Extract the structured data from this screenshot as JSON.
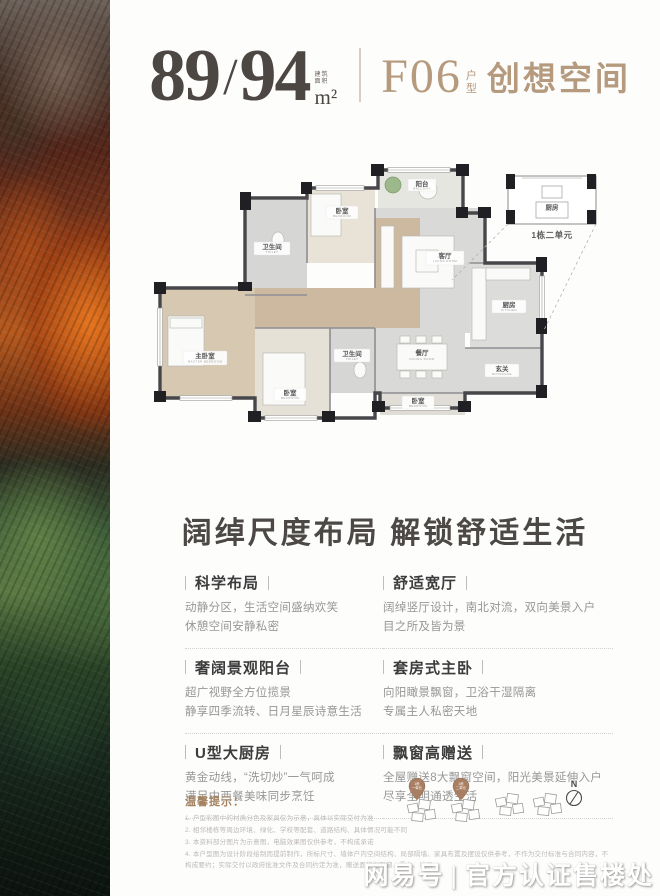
{
  "header": {
    "area_main": "89",
    "area_slash": "/",
    "area_alt": "94",
    "area_note_1": "建筑",
    "area_note_2": "面积",
    "area_unit": "m²",
    "type_code": "F06",
    "type_label_1": "户",
    "type_label_2": "型",
    "type_name": "创想空间"
  },
  "floorplan": {
    "rooms": [
      {
        "name": "阳台",
        "en": "BALCONY"
      },
      {
        "name": "卧室",
        "en": "BEDROOM"
      },
      {
        "name": "卫生间",
        "en": "TOILET"
      },
      {
        "name": "客厅",
        "en": "LIVING ROOM"
      },
      {
        "name": "厨房",
        "en": "KITCHEN"
      },
      {
        "name": "玄关",
        "en": "ENTRANCE"
      },
      {
        "name": "餐厅",
        "en": "DINING ROOM"
      },
      {
        "name": "卫生间",
        "en": "TOILET"
      },
      {
        "name": "主卧室",
        "en": "MASTER BEDROOM"
      },
      {
        "name": "卧室",
        "en": "BEDROOM"
      },
      {
        "name": "卧室",
        "en": "BEDROOM"
      }
    ],
    "inset": {
      "label": "1栋二单元",
      "room": "厨房"
    }
  },
  "section_title": "阔绰尺度布局 解锁舒适生活",
  "features": [
    {
      "title": "科学布局",
      "line1": "动静分区，生活空间盛纳欢笑",
      "line2": "休憩空间安静私密"
    },
    {
      "title": "舒适宽厅",
      "line1": "阔绰竖厅设计，南北对流，双向美景入户",
      "line2": "目之所及皆为景"
    },
    {
      "title": "奢阔景观阳台",
      "line1": "超广视野全方位揽景",
      "line2": "静享四季流转、日月星辰诗意生活"
    },
    {
      "title": "套房式主卧",
      "line1": "向阳瞰景飘窗，卫浴干湿隔离",
      "line2": "专属主人私密天地"
    },
    {
      "title": "U型大厨房",
      "line1": "黄金动线，“洗切炒”一气呵成",
      "line2": "满足中西餐美味同步烹饪"
    },
    {
      "title": "飘窗高赠送",
      "line1": "全屋赠送8大飘窗空间，阳光美景延伸入户",
      "line2": "尽享全明通透生活"
    }
  ],
  "tips": {
    "title": "温馨提示：",
    "line1": "1. 户型彩图中的材质分色及家具仅为示意，具体以实际交付为准",
    "line2": "2. 相邻楼栋等周边环境、绿化、学校等配套、道路结构、具体情况可能不同",
    "line3": "3. 本资料部分图片为示意图，电脑效果图仅供参考，不构成承诺",
    "line4": "4. 本户型图为设计阶段绘制而提前制作，所标尺寸、墙体户内空间结构、局部隔墙、家具布置及摆设仅供参考，不作为交付标准与合同内容，不构成要约；实际交付以政府批准文件及合同约定为准，赠送面积指飘窗、露台、扩展"
  },
  "site": {
    "pin1": "1栋一单元",
    "pin2": "1栋二单元",
    "compass": "N"
  },
  "watermark": {
    "brand": "网易号",
    "sep": "|",
    "label": "官方认证售楼处"
  }
}
